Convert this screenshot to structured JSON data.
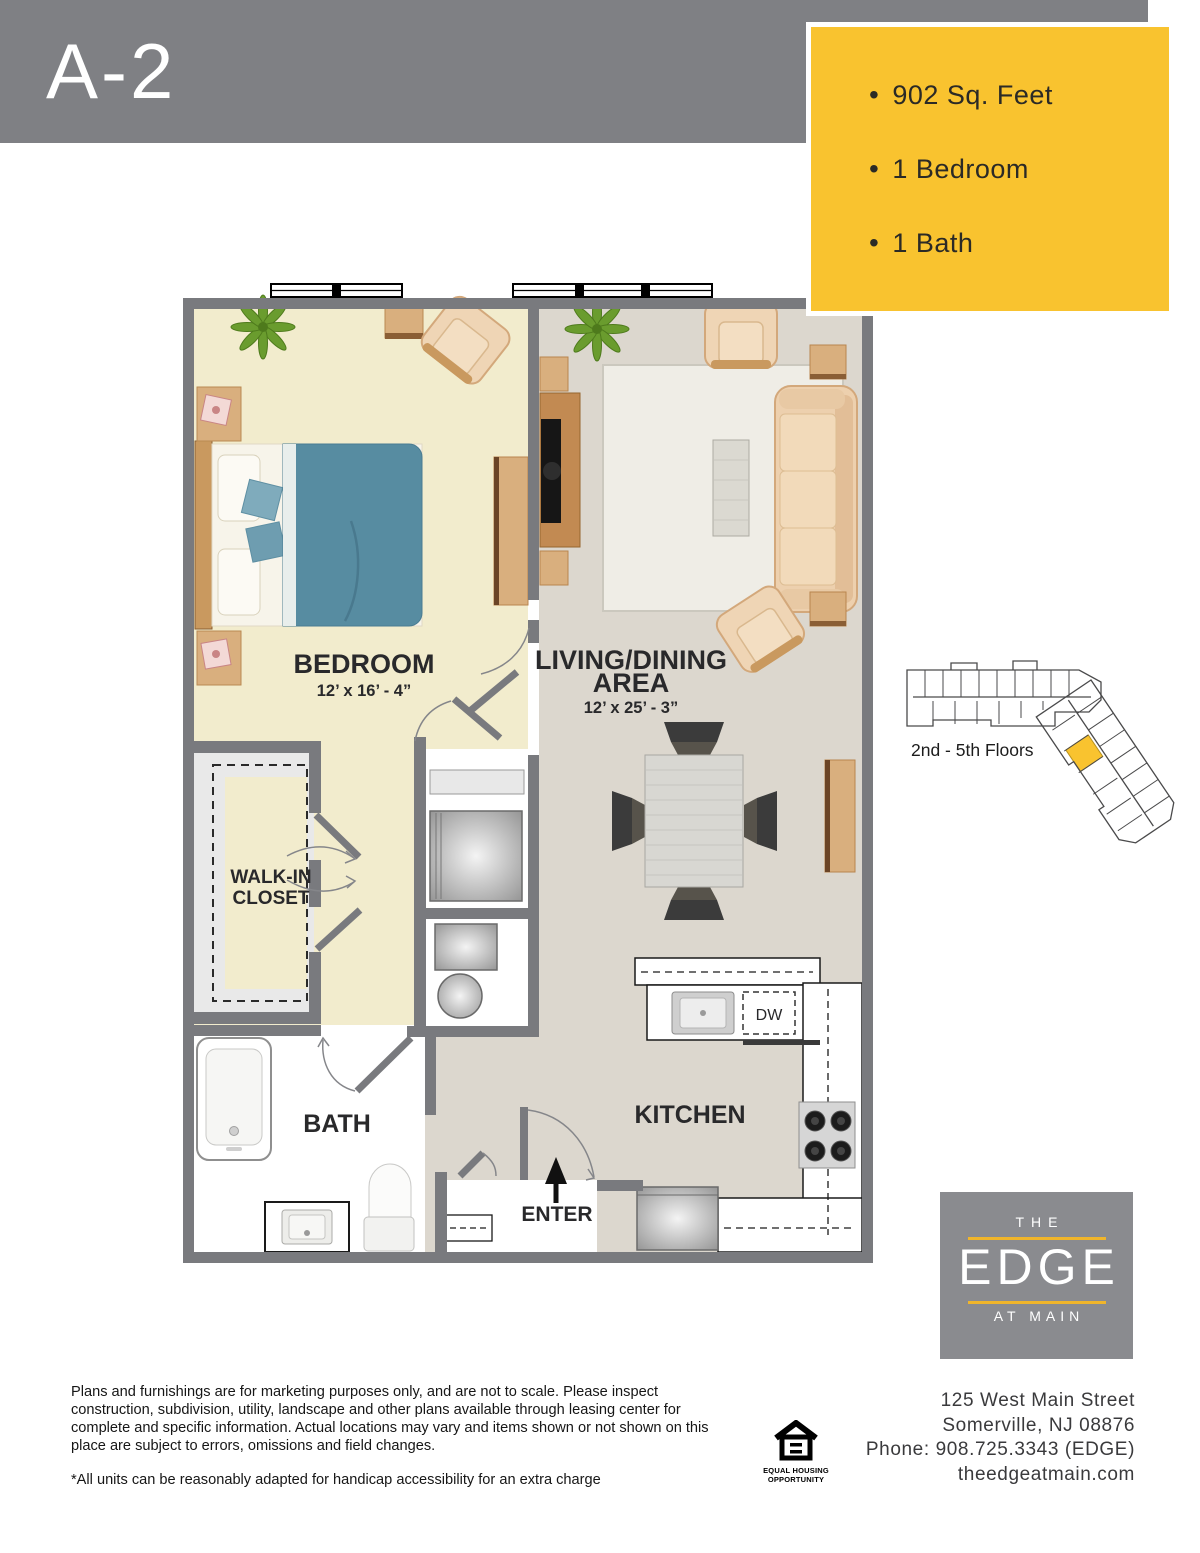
{
  "header": {
    "unit_name": "A-2"
  },
  "specs_box": {
    "items": [
      "902 Sq. Feet",
      "1 Bedroom",
      "1 Bath"
    ]
  },
  "plan": {
    "bedroom_name": "BEDROOM",
    "bedroom_dims": "12’ x 16’ - 4”",
    "living_name_line1": "LIVING/DINING",
    "living_name_line2": "AREA",
    "living_dims": "12’ x 25’ - 3”",
    "closet_line1": "WALK-IN",
    "closet_line2": "CLOSET",
    "bath_name": "BATH",
    "kitchen_name": "KITCHEN",
    "dishwasher_abbr": "DW",
    "enter_label": "ENTER"
  },
  "key_plan": {
    "caption": "2nd - 5th Floors"
  },
  "logo": {
    "top": "THE",
    "main": "EDGE",
    "bottom": "AT MAIN"
  },
  "contact": {
    "line1": "125 West Main Street",
    "line2": "Somerville, NJ 08876",
    "line3": "Phone: 908.725.3343 (EDGE)",
    "line4": "theedgeatmain.com"
  },
  "disclaimer": {
    "body": "Plans and furnishings are for marketing purposes only, and are not to scale. Please inspect construction, subdivision, utility, landscape and other plans available through leasing center for complete and specific information. Actual locations may vary and items shown or not shown on this place are subject to errors, omissions and field changes.",
    "note": "*All units can be reasonably adapted for handicap accessibility for an extra charge"
  },
  "equal_housing": {
    "line1": "EQUAL HOUSING",
    "line2": "OPPORTUNITY"
  },
  "colors": {
    "accent_yellow": "#F9C32F",
    "header_gray": "#7F8084",
    "wall_gray": "#797A7E",
    "logo_gray": "#8A8B8F",
    "bedroom_floor": "#F2ECCD",
    "living_floor": "#DCD7CE",
    "bed_teal": "#578CA1"
  }
}
